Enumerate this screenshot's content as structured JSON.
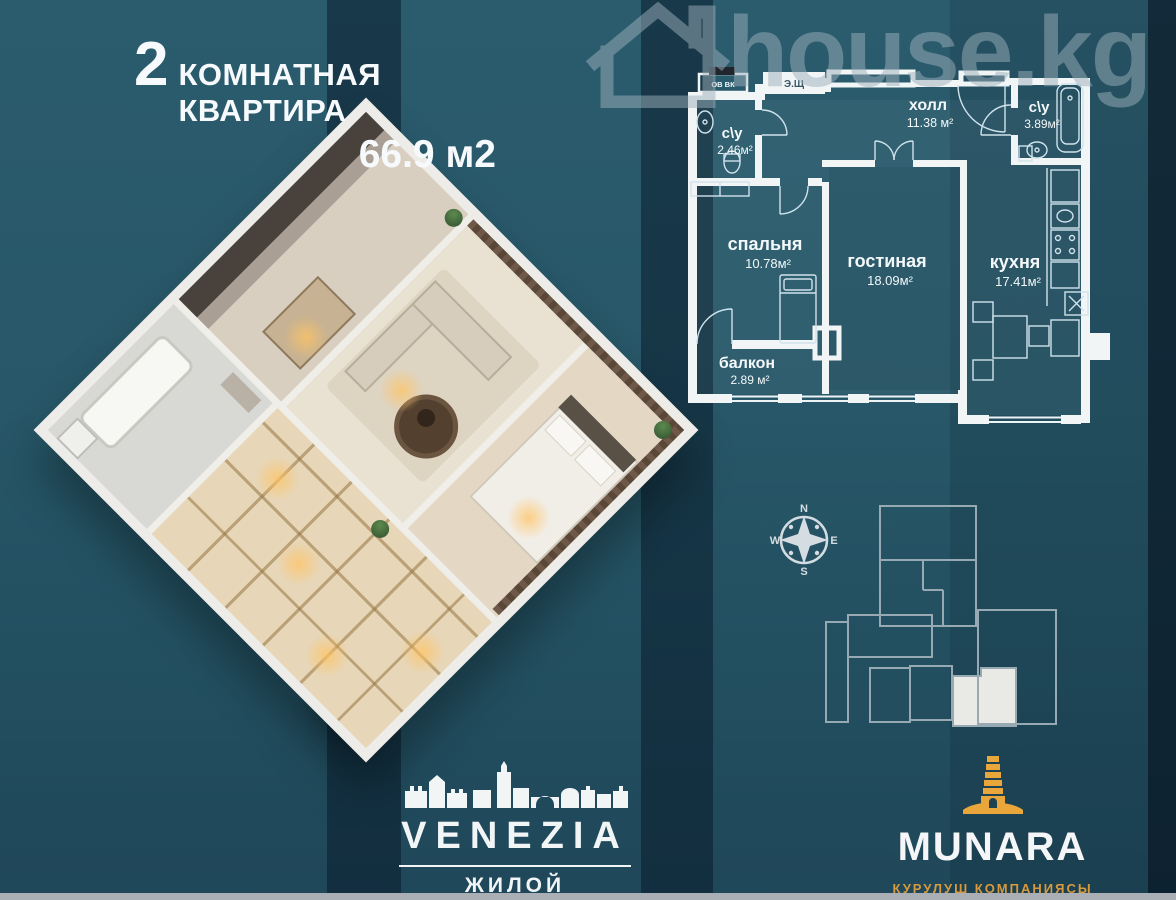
{
  "header": {
    "count": "2",
    "label": "КОМНАТНАЯ КВАРТИРА",
    "area": "66.9 м2"
  },
  "watermark": {
    "brand": "house.kg"
  },
  "plan2d": {
    "rooms": [
      {
        "name": "с\\у",
        "area": "2.46м²"
      },
      {
        "name": "холл",
        "area": "11.38 м²"
      },
      {
        "name": "с\\у",
        "area": "3.89м²"
      },
      {
        "name": "спальня",
        "area": "10.78м²"
      },
      {
        "name": "гостиная",
        "area": "18.09м²"
      },
      {
        "name": "кухня",
        "area": "17.41м²"
      },
      {
        "name": "балкон",
        "area": "2.89 м²"
      }
    ],
    "labels": {
      "ovvk": "ОВ ВК",
      "esh": "Э.Щ"
    }
  },
  "compass": {
    "n": "N",
    "w": "W",
    "e": "E",
    "s": "S"
  },
  "venezia": {
    "name": "VENEZIA",
    "subtitle": "ЖИЛОЙ КОМПЛЕКС"
  },
  "munara": {
    "name": "MUNARA",
    "subtitle": "КУРУЛУШ КОМПАНИЯСЫ"
  },
  "colors": {
    "background_teal": "#265667",
    "stripe_navy": "#1a394e",
    "wall_white": "#f2f5f6",
    "accent_orange": "#e9a63b",
    "watermark_gray": "#9db0bc",
    "footer_bar_gray": "#a9afb4"
  }
}
